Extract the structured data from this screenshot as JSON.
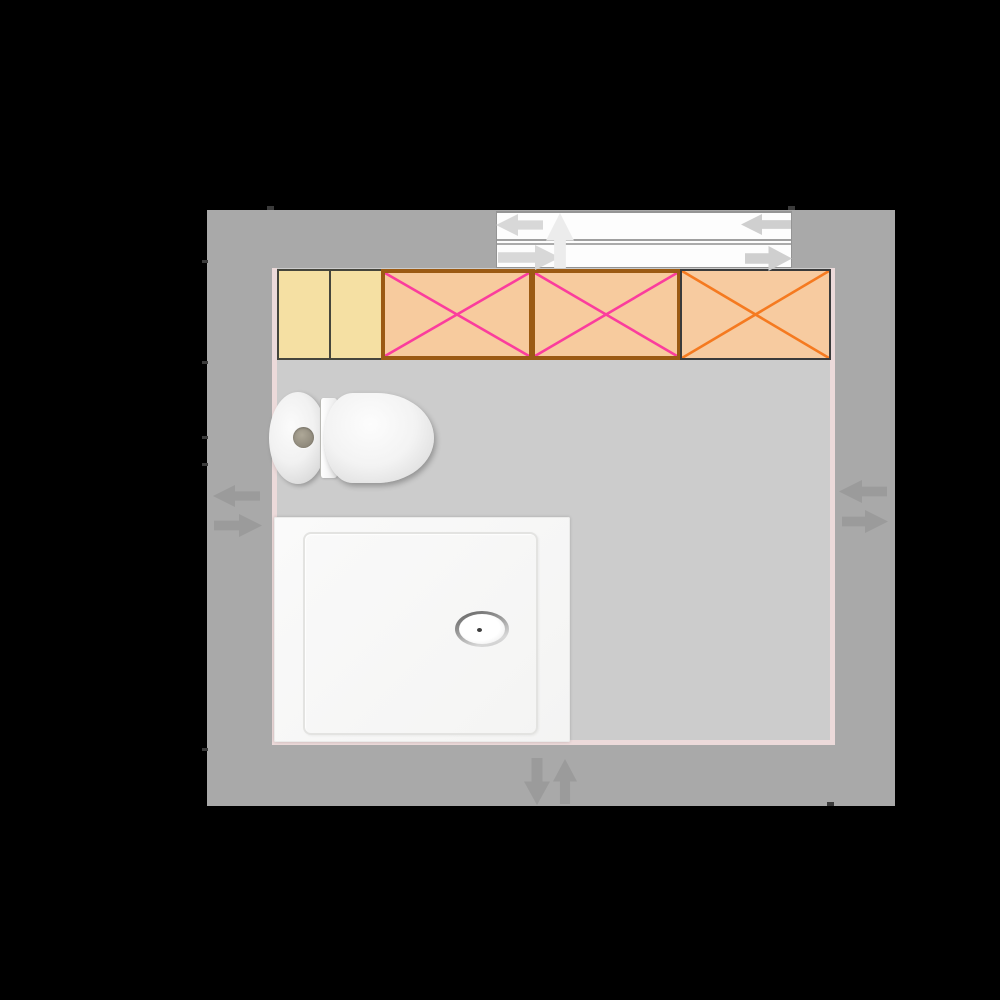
{
  "app": {
    "name": "bathroom-floor-planner",
    "canvas": {
      "width": 1000,
      "height": 1000,
      "background": "#000000"
    }
  },
  "room": {
    "wall": {
      "x": 207,
      "y": 210,
      "w": 688,
      "h": 596,
      "color": "#a9a9a9"
    },
    "floor": {
      "x": 272,
      "y": 268,
      "w": 563,
      "h": 477,
      "color": "#ecdada"
    },
    "floor_surface_color": "#cccccc",
    "inner_edge_color": "#ecdada",
    "ticks": {
      "color": "#3b3b3b",
      "items": [
        {
          "x": 267,
          "y": 206,
          "w": 7,
          "h": 4
        },
        {
          "x": 788,
          "y": 206,
          "w": 7,
          "h": 4
        },
        {
          "x": 202,
          "y": 260,
          "w": 6,
          "h": 3
        },
        {
          "x": 202,
          "y": 361,
          "w": 6,
          "h": 3
        },
        {
          "x": 202,
          "y": 436,
          "w": 6,
          "h": 3
        },
        {
          "x": 202,
          "y": 463,
          "w": 6,
          "h": 3
        },
        {
          "x": 202,
          "y": 748,
          "w": 6,
          "h": 3
        },
        {
          "x": 827,
          "y": 802,
          "w": 7,
          "h": 4
        }
      ]
    }
  },
  "window": {
    "x": 496,
    "y": 211,
    "w": 296,
    "h": 57,
    "fill": "#fdfdfd",
    "frame_color": "#949494",
    "sash_lines": [
      {
        "offset": 26,
        "h": 2,
        "color": "#9f9f9f"
      },
      {
        "offset": 30,
        "h": 2,
        "color": "#ababab"
      }
    ]
  },
  "furniture": {
    "cabinets": [
      {
        "name": "cabinet-plain-1",
        "x": 277,
        "y": 269,
        "w": 54,
        "h": 91,
        "fill": "#f5e0a3",
        "border_color": "#45453c",
        "border_w": 2,
        "cross_color": null
      },
      {
        "name": "cabinet-plain-2",
        "x": 329,
        "y": 269,
        "w": 54,
        "h": 91,
        "fill": "#f5e0a3",
        "border_color": "#45453c",
        "border_w": 2,
        "cross_color": null
      },
      {
        "name": "cabinet-crossed-1",
        "x": 381,
        "y": 269,
        "w": 152,
        "h": 91,
        "fill": "#f7cb9e",
        "border_color": "#9b5a13",
        "border_w": 4,
        "cross_color": "#fb3d9d"
      },
      {
        "name": "cabinet-crossed-2",
        "x": 531,
        "y": 269,
        "w": 150,
        "h": 91,
        "fill": "#f7cb9e",
        "border_color": "#9b5a13",
        "border_w": 4,
        "cross_color": "#fb3d9d"
      },
      {
        "name": "cabinet-crossed-3",
        "x": 680,
        "y": 269,
        "w": 151,
        "h": 91,
        "fill": "#f7cba0",
        "border_color": "#3a3a3a",
        "border_w": 2,
        "cross_color": "#f57a20"
      }
    ],
    "toilet": {
      "tank": {
        "x": 269,
        "y": 392,
        "w": 58,
        "h": 92
      },
      "hinge": {
        "x": 320,
        "y": 398,
        "w": 16,
        "h": 80
      },
      "seat": {
        "x": 324,
        "y": 393,
        "w": 110,
        "h": 90
      },
      "flush_button": {
        "x": 293,
        "y": 427,
        "w": 21,
        "h": 21
      }
    },
    "shower": {
      "tray": {
        "x": 274,
        "y": 517,
        "w": 296,
        "h": 225
      },
      "inner_rim": {
        "x": 303,
        "y": 532,
        "w": 231,
        "h": 199
      },
      "drain": {
        "x": 455,
        "y": 611,
        "w": 54,
        "h": 36
      }
    }
  },
  "handles": {
    "wall_arrow_color": "#9b9b9b",
    "items": [
      {
        "name": "window-move-left-arrow",
        "x": 496,
        "y": 214,
        "w": 47,
        "h": 22,
        "dir": "left",
        "color": "#d8d8d8"
      },
      {
        "name": "window-move-right-arrow",
        "x": 498,
        "y": 245,
        "w": 62,
        "h": 25,
        "dir": "right",
        "color": "#d8d8d8"
      },
      {
        "name": "window-move-up-arrow",
        "x": 546,
        "y": 213,
        "w": 28,
        "h": 55,
        "dir": "up",
        "color": "#ececec"
      },
      {
        "name": "window-end-left-arrow",
        "x": 741,
        "y": 214,
        "w": 50,
        "h": 21,
        "dir": "left",
        "color": "#cfcfcf"
      },
      {
        "name": "window-end-right-arrow",
        "x": 745,
        "y": 246,
        "w": 47,
        "h": 25,
        "dir": "right",
        "color": "#cfcfcf"
      },
      {
        "name": "left-wall-left-arrow",
        "x": 213,
        "y": 485,
        "w": 47,
        "h": 22,
        "dir": "left",
        "color": "#9b9b9b"
      },
      {
        "name": "left-wall-right-arrow",
        "x": 214,
        "y": 514,
        "w": 48,
        "h": 23,
        "dir": "right",
        "color": "#9b9b9b"
      },
      {
        "name": "right-wall-left-arrow",
        "x": 839,
        "y": 480,
        "w": 48,
        "h": 23,
        "dir": "left",
        "color": "#9b9b9b"
      },
      {
        "name": "right-wall-right-arrow",
        "x": 842,
        "y": 510,
        "w": 46,
        "h": 23,
        "dir": "right",
        "color": "#9b9b9b"
      },
      {
        "name": "bottom-wall-down-arrow",
        "x": 524,
        "y": 758,
        "w": 26,
        "h": 47,
        "dir": "down",
        "color": "#9b9b9b"
      },
      {
        "name": "bottom-wall-up-arrow",
        "x": 553,
        "y": 759,
        "w": 24,
        "h": 45,
        "dir": "up",
        "color": "#9b9b9b"
      }
    ]
  }
}
